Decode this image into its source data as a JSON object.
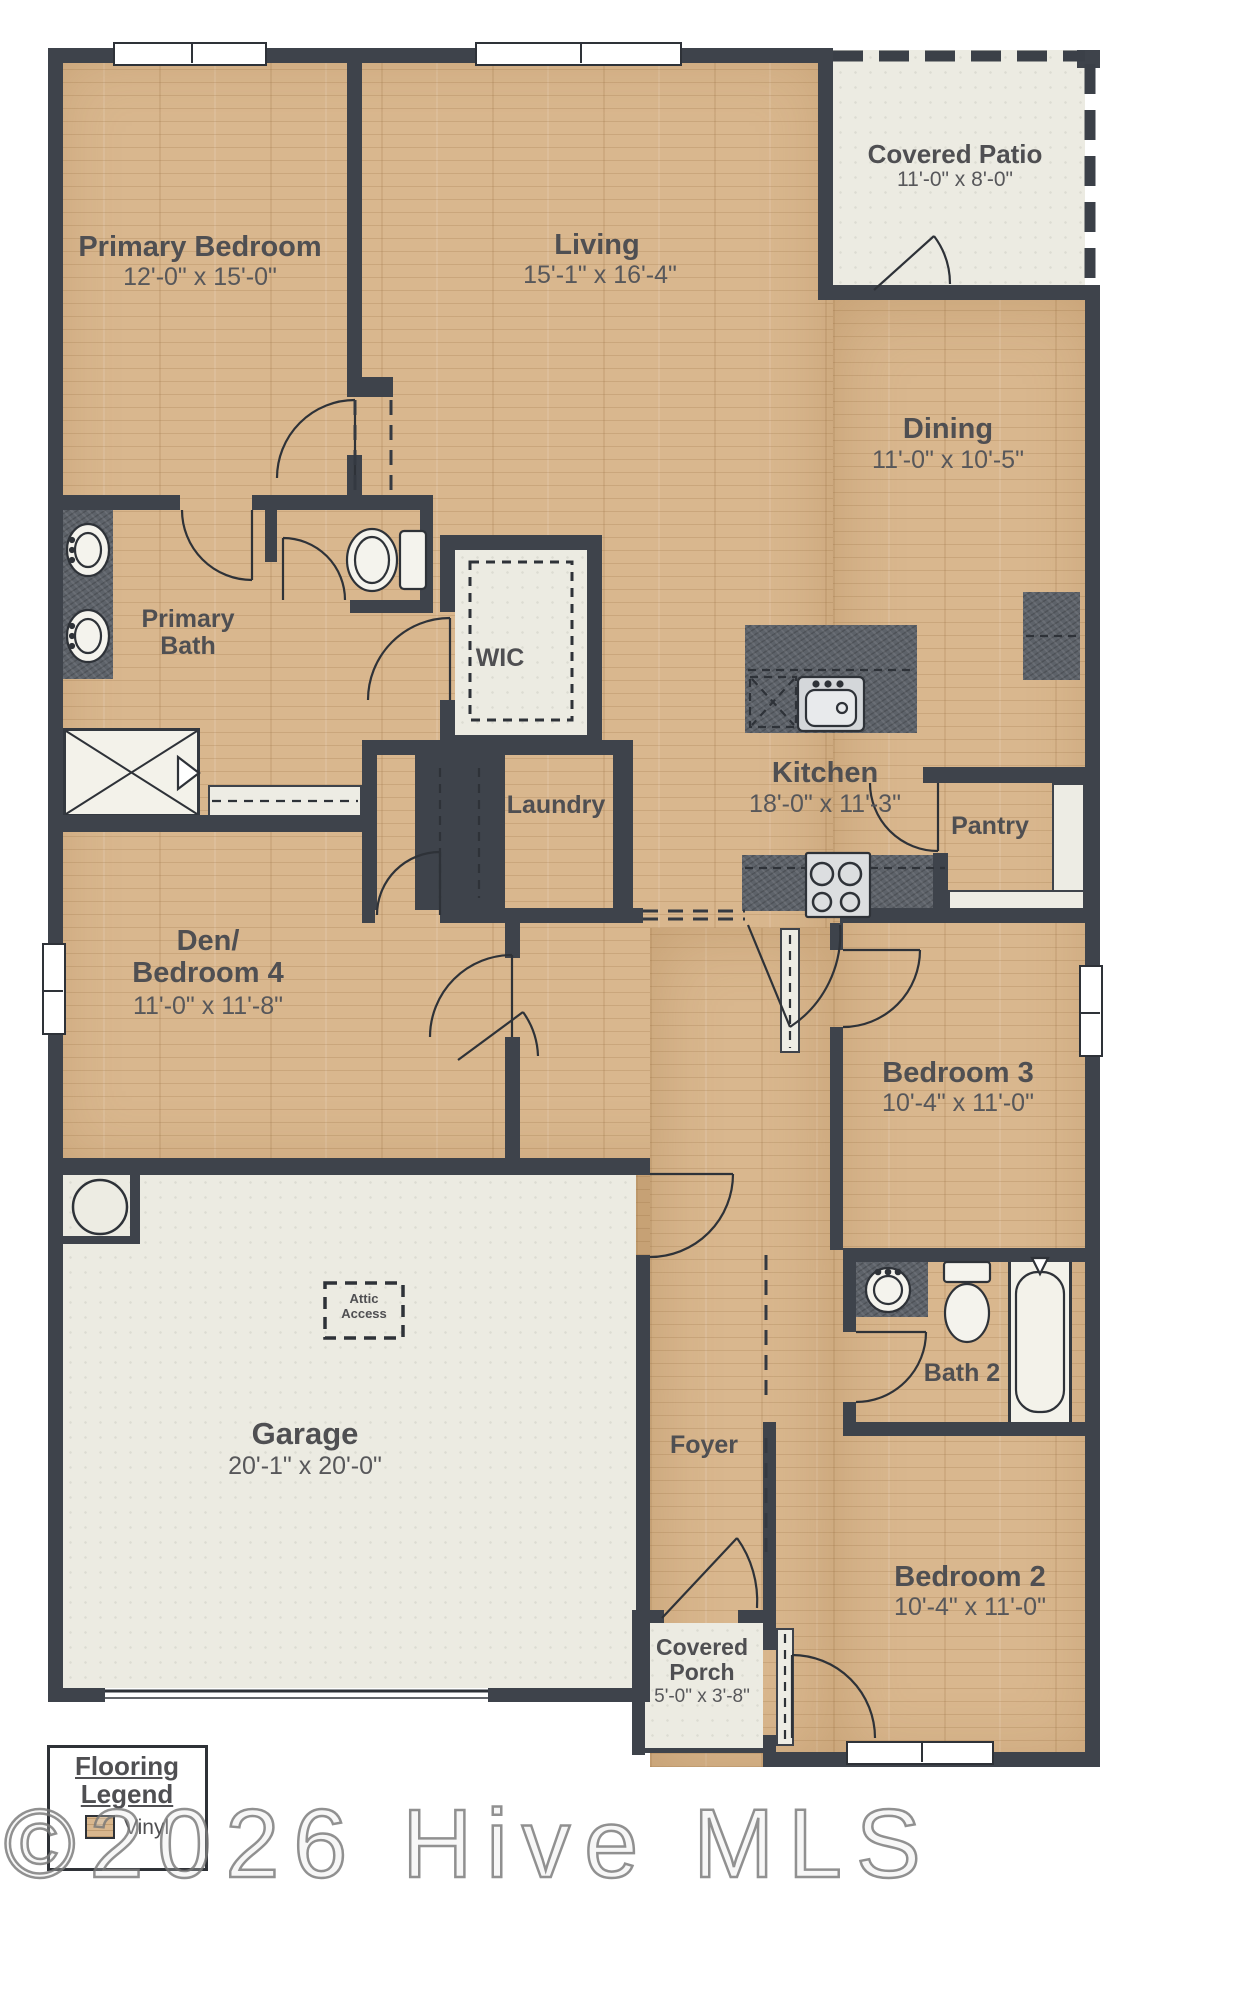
{
  "watermark": "©2026 Hive MLS",
  "flooring_legend": {
    "line1": "Flooring",
    "line2": "Legend",
    "item1": "Vinyl"
  },
  "attic": {
    "line1": "Attic",
    "line2": "Access"
  },
  "rooms": {
    "primary_bedroom": {
      "name": "Primary Bedroom",
      "dims": "12'-0\" x 15'-0\""
    },
    "living": {
      "name": "Living",
      "dims": "15'-1\" x 16'-4\""
    },
    "covered_patio": {
      "name": "Covered Patio",
      "dims": "11'-0\" x 8'-0\""
    },
    "dining": {
      "name": "Dining",
      "dims": "11'-0\" x 10'-5\""
    },
    "primary_bath": {
      "line1": "Primary",
      "line2": "Bath"
    },
    "wic": {
      "name": "WIC"
    },
    "laundry": {
      "name": "Laundry"
    },
    "kitchen": {
      "name": "Kitchen",
      "dims": "18'-0\" x 11'-3\""
    },
    "pantry": {
      "name": "Pantry"
    },
    "den_bedroom4": {
      "line1": "Den/",
      "line2": "Bedroom 4",
      "dims": "11'-0\" x 11'-8\""
    },
    "bedroom3": {
      "name": "Bedroom 3",
      "dims": "10'-4\" x 11'-0\""
    },
    "garage": {
      "name": "Garage",
      "dims": "20'-1\" x 20'-0\""
    },
    "foyer": {
      "name": "Foyer"
    },
    "bath2": {
      "name": "Bath 2"
    },
    "bedroom2": {
      "name": "Bedroom 2",
      "dims": "10'-4\" x 11'-0\""
    },
    "covered_porch": {
      "line1": "Covered",
      "line2": "Porch",
      "dims": "5'-0\" x 3'-8\""
    }
  },
  "colors": {
    "wall": "#3e434b",
    "wood": "#d9b78e",
    "hard_surface": "#ecebe2",
    "counter": "#5d6269",
    "label_text": "#4f4f52"
  }
}
